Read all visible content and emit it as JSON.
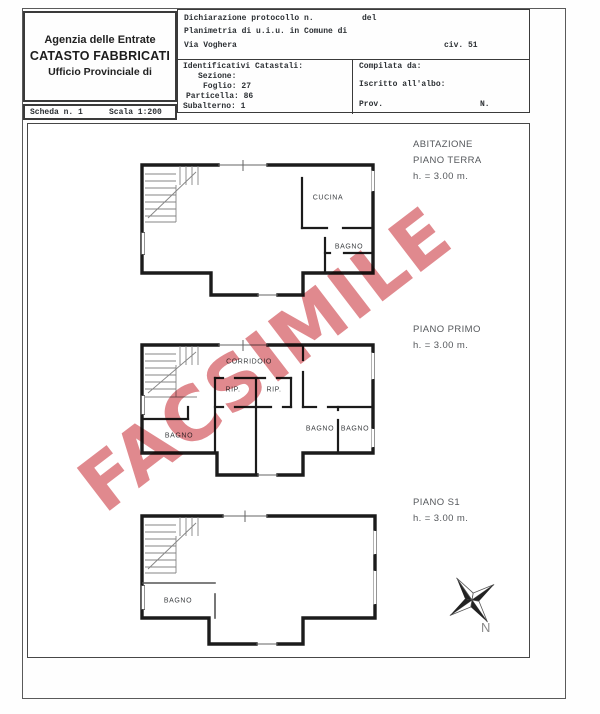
{
  "header": {
    "agency_line1": "Agenzia delle Entrate",
    "agency_line2": "CATASTO FABBRICATI",
    "agency_line3": "Ufficio Provinciale di",
    "scheda_label": "Scheda n. 1",
    "scala_label": "Scala 1:200",
    "decl_line1_left": "Dichiarazione protocollo n.",
    "decl_line1_right": "del",
    "decl_line2": "Planimetria di u.i.u. in Comune di",
    "decl_line3_left": "Via Voghera",
    "decl_line3_right": "civ. 51",
    "cat_title": "Identificativi Catastali:",
    "cat_sezione": "Sezione:",
    "cat_foglio": "Foglio: 27",
    "cat_particella": "Particella: 86",
    "cat_subalterno": "Subalterno: 1",
    "comp_line1": "Compilata da:",
    "comp_line2": "Iscritto all'albo:",
    "comp_line3_left": "Prov.",
    "comp_line3_right": "N."
  },
  "floors": [
    {
      "label_line1": "ABITAZIONE",
      "label_line2": "PIANO TERRA",
      "label_height": "h. = 3.00 m.",
      "rooms": [
        "CUCINA",
        "BAGNO"
      ]
    },
    {
      "label_line2": "PIANO PRIMO",
      "label_height": "h. = 3.00 m.",
      "rooms": [
        "CORRIDOIO",
        "RIP.",
        "RIP.",
        "BAGNO",
        "BAGNO",
        "BAGNO"
      ]
    },
    {
      "label_line2": "PIANO S1",
      "label_height": "h. = 3.00 m.",
      "rooms": [
        "BAGNO"
      ]
    }
  ],
  "watermark": {
    "text": "FACSIMILE",
    "color": "#e0898e"
  },
  "compass": {
    "label": "N"
  }
}
